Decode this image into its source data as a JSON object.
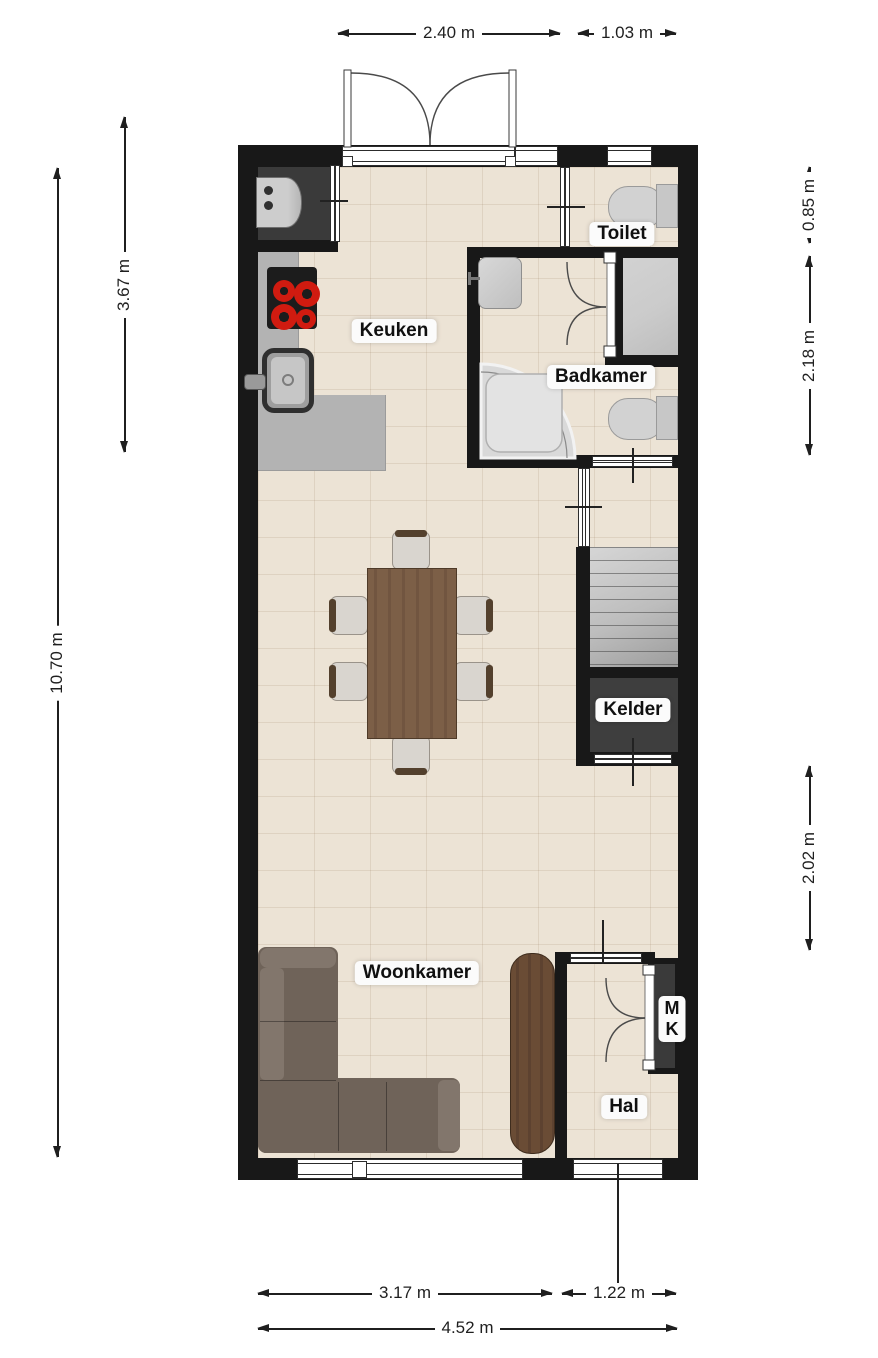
{
  "rooms": {
    "keuken": {
      "label": "Keuken"
    },
    "toilet": {
      "label": "Toilet"
    },
    "badkamer": {
      "label": "Badkamer"
    },
    "kelder": {
      "label": "Kelder"
    },
    "woonkamer": {
      "label": "Woonkamer"
    },
    "hal": {
      "label": "Hal"
    },
    "meterkast": {
      "line1": "M",
      "line2": "K"
    }
  },
  "dimensions": {
    "top_doors": "2.40 m",
    "top_toilet": "1.03 m",
    "left_kitchen": "3.67 m",
    "left_total": "10.70 m",
    "right_toilet": "0.85 m",
    "right_badkamer": "2.18 m",
    "right_stair_hal": "2.02 m",
    "bottom_woonkamer": "3.17 m",
    "bottom_hal": "1.22 m",
    "bottom_total": "4.52 m"
  },
  "colors": {
    "wall": "#181818",
    "floor": "#ece3d5",
    "counter": "#b3b3b3",
    "appliance-niche": "#3a3a3a",
    "stairs-light": "#d6d6d6",
    "stairs-dark": "#9d9d9d",
    "kelder": "#3e3e3e",
    "closet": "#cbcbcb",
    "sofa": "#6f6359",
    "sofa-light": "#82766c",
    "table": "#7c5f47",
    "cabinet": "#6a4c35",
    "chair-seat": "#d9d5cf",
    "chair-frame": "#53402d",
    "burner": "#d01b10",
    "fixture": "#d2d2d2",
    "dim": "#1f1f1f",
    "label-bg": "#fbfbfb"
  }
}
